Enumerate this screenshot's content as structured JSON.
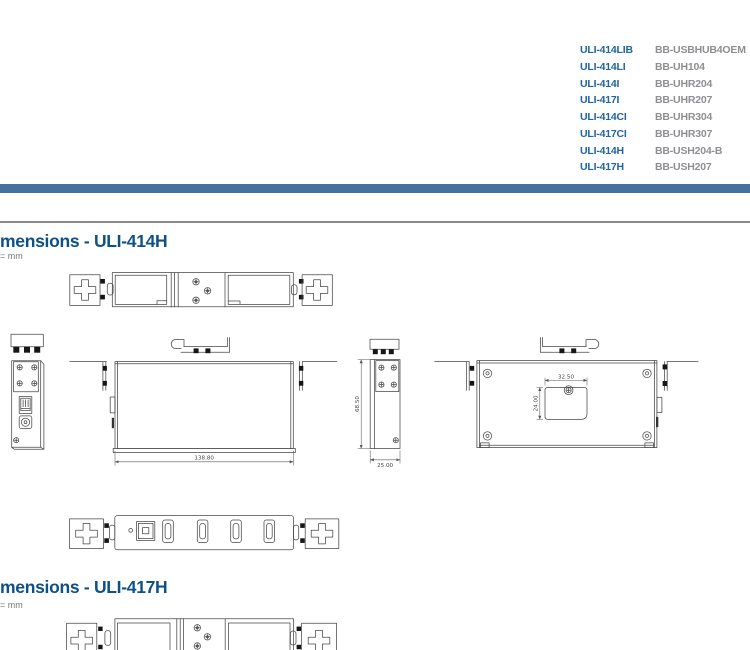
{
  "product_table": {
    "rows": [
      {
        "model": "ULI-414LIB",
        "alt": "BB-USBHUB4OEM"
      },
      {
        "model": "ULI-414LI",
        "alt": "BB-UH104"
      },
      {
        "model": "ULI-414I",
        "alt": "BB-UHR204"
      },
      {
        "model": "ULI-417I",
        "alt": "BB-UHR207"
      },
      {
        "model": "ULI-414CI",
        "alt": "BB-UHR304"
      },
      {
        "model": "ULI-417CI",
        "alt": "BB-UHR307"
      },
      {
        "model": "ULI-414H",
        "alt": "BB-USH204-B"
      },
      {
        "model": "ULI-417H",
        "alt": "BB-USH207"
      }
    ]
  },
  "section_414h": {
    "title": "mensions - ULI-414H",
    "unit_label": "= mm",
    "dimensions": {
      "width": "138.80",
      "height": "68.50",
      "depth": "25.00",
      "cutout_width": "32.50",
      "cutout_height": "24.00"
    }
  },
  "section_417h": {
    "title": "mensions - ULI-417H",
    "unit_label": "= mm"
  },
  "colors": {
    "divider_bar": "#44719f",
    "heading": "#0d5187",
    "model_text": "#1f64a3",
    "part_text": "#8d8f92",
    "drawing_line": "#474747"
  }
}
